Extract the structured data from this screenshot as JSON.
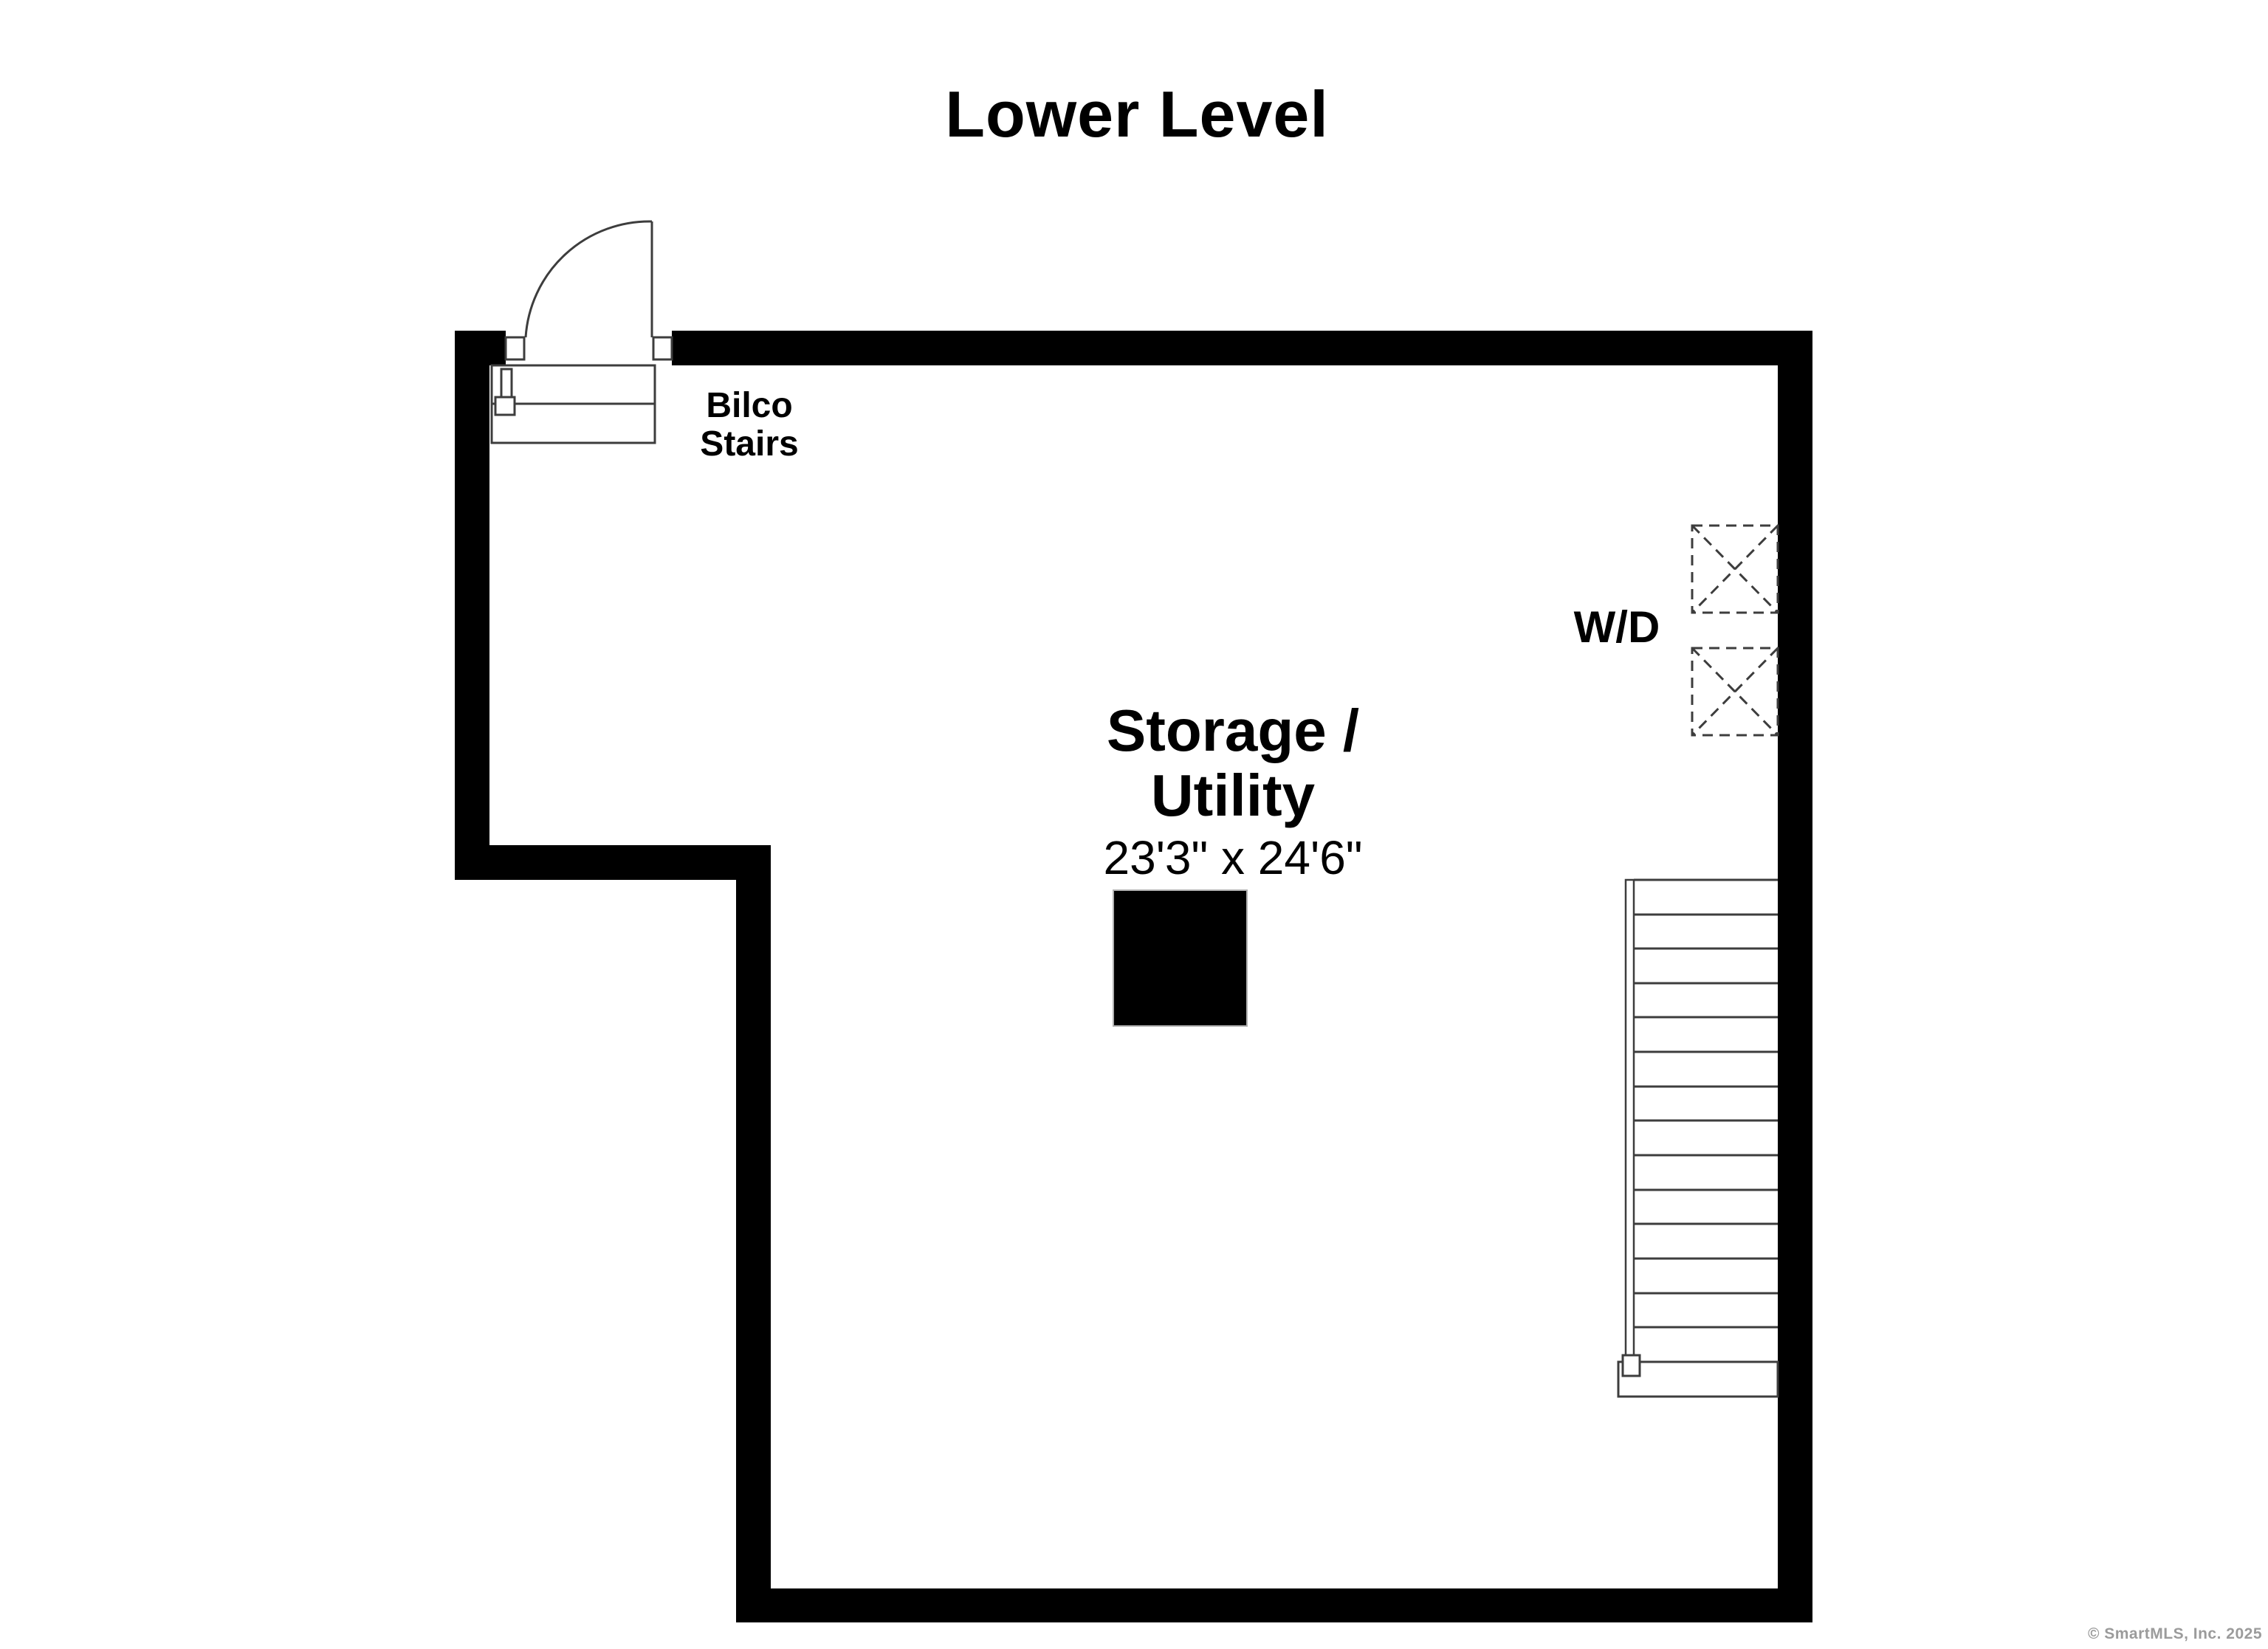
{
  "title": "Lower Level",
  "labels": {
    "bilco_line1": "Bilco",
    "bilco_line2": "Stairs",
    "washer_dryer": "W/D",
    "room_line1": "Storage /",
    "room_line2": "Utility",
    "room_dimensions": "23'3\" x 24'6\""
  },
  "footer": {
    "copyright": "© SmartMLS, Inc.  2025"
  },
  "colors": {
    "background": "#ffffff",
    "wall": "#000000",
    "line": "#3d3d3d",
    "column_border": "#b0b0b0",
    "copyright_text": "#9b9b9b"
  }
}
